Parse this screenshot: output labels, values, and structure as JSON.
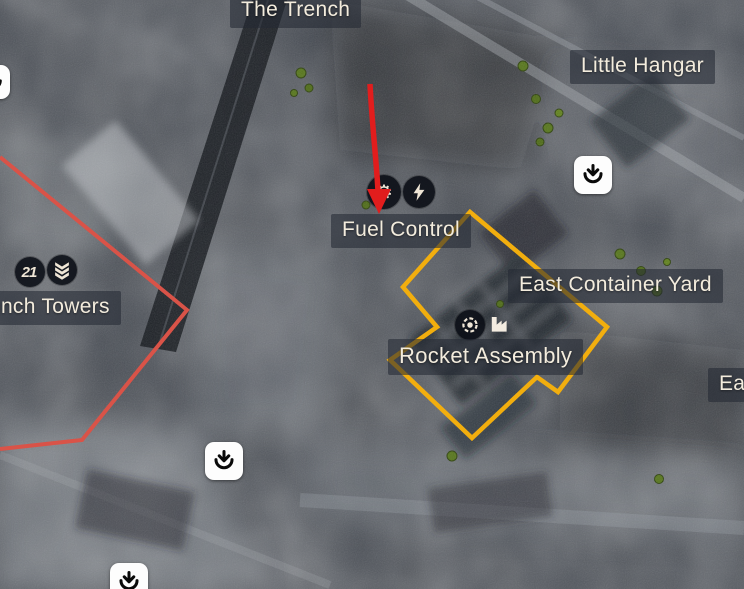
{
  "labels": {
    "the_trench": "The Trench",
    "little_hangar": "Little Hangar",
    "fuel_control": "Fuel Control",
    "east_container_yard": "East Container Yard",
    "rocket_assembly": "Rocket Assembly",
    "launch_towers": "Launch Towers",
    "east_cutoff": "Ea"
  },
  "icons": {
    "badge_value": "21",
    "gear_glyph": "⚙",
    "deploy_name": "deploy-insertion-point",
    "lightning_name": "electricity-objective",
    "gear_name": "repair-objective",
    "eye_name": "intel-objective",
    "factory_name": "factory-objective",
    "chevrons_name": "rank-chevrons"
  },
  "colors": {
    "zone_outline": "#F2AE0E",
    "boundary_line": "#D95348",
    "attack_arrow": "#E11D1D",
    "label_text": "#F3ECDD",
    "icon_glyph": "#EFE6D6"
  }
}
